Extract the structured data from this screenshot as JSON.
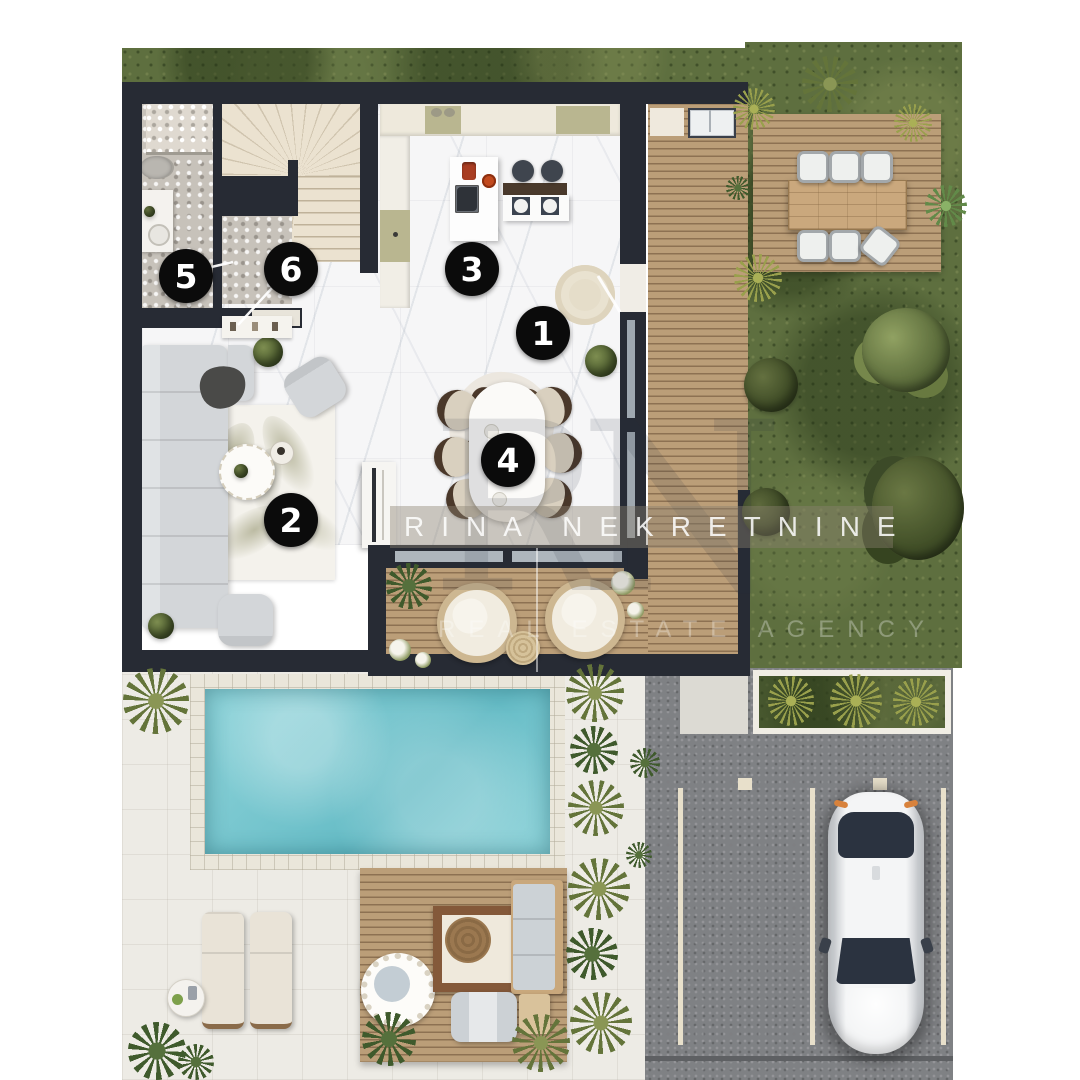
{
  "watermark": {
    "brand": "RINA NEKRETNINE",
    "monogram": "RN",
    "tagline": "REAL ESTATE AGENCY"
  },
  "marker_radius": 27,
  "markers": [
    {
      "n": "1",
      "x": 543,
      "y": 333
    },
    {
      "n": "2",
      "x": 291,
      "y": 520
    },
    {
      "n": "3",
      "x": 472,
      "y": 269
    },
    {
      "n": "4",
      "x": 508,
      "y": 460
    },
    {
      "n": "5",
      "x": 186,
      "y": 276
    },
    {
      "n": "6",
      "x": 291,
      "y": 269
    }
  ],
  "colors": {
    "wall": "#272b34",
    "marble": "#f6f6f7",
    "pebble": "#c7c2ba",
    "stairs": "#ebe2d0",
    "deck_a": "#bb9e78",
    "deck_b": "#8d7152",
    "garden": "#5e6f3f",
    "terrace": "#edebe5",
    "asphalt": "#7f8184",
    "pool_a": "#8fd4da",
    "pool_b": "#66bcc6",
    "pool_border": "#eae6da",
    "parkline": "#e8e0cb",
    "sofa": "#d3d6d9",
    "wood": "#caa87d",
    "marker_bg": "#0b0b0b",
    "marker_fg": "#ffffff",
    "band": "rgba(138,128,112,0.42)"
  }
}
